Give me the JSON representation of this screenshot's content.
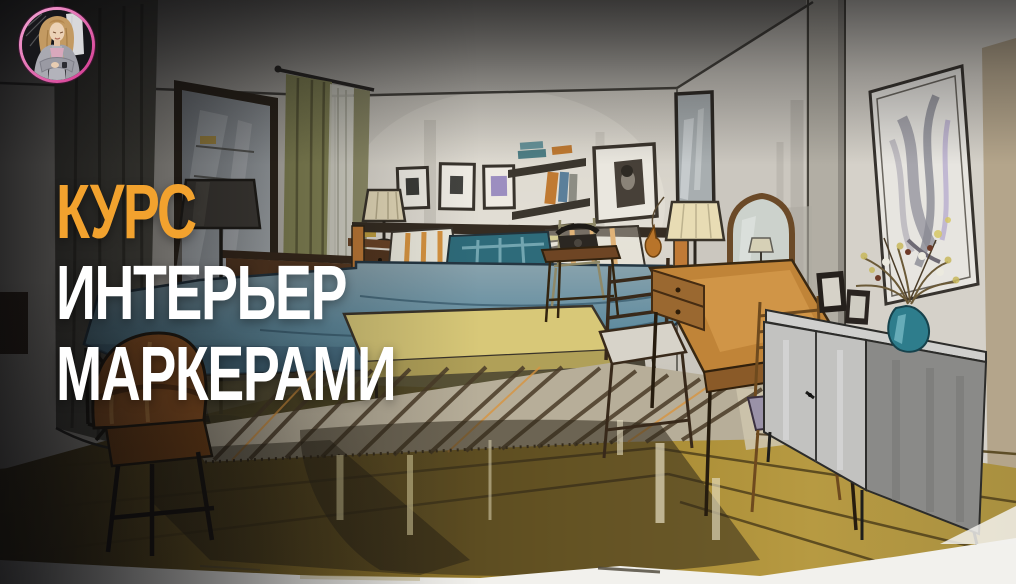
{
  "meta": {
    "kind": "video-thumbnail",
    "width": 1016,
    "height": 584
  },
  "theme": {
    "accent-orange": "#F2A22E",
    "title-white": "#FFFFFF",
    "ring-pink": "#D4368F",
    "ring-pink-light": "#F4A8D6"
  },
  "overlay": {
    "title_lines": [
      {
        "text": "КУРС"
      },
      {
        "text": "ИНТЕРЬЕР"
      },
      {
        "text": "МАРКЕРАМИ"
      }
    ]
  },
  "avatar": {
    "description": "Illustrated woman with long sandy hair, gray cardigan, arms crossed, in a pink ring"
  },
  "scene": {
    "medium": "hand-drawn marker sketch",
    "subject": "classic bedroom interior in two-point perspective",
    "objects": [
      "dark curtain at left edge",
      "wall mirror",
      "window with olive curtains and sheer",
      "floor lamp with dark shade",
      "chest of drawers",
      "nightstand with small lamp",
      "three framed pictures above bed",
      "wall shelves with books",
      "bed with teal bedding and striped pillows",
      "yellow bench at foot of bed",
      "striped rug",
      "framed portrait",
      "tall corner mirror",
      "telephone table with rotary phone",
      "ladder-back chair",
      "vanity desk with pleated lamp and arched mirror",
      "chair with lavender cushion",
      "gray credenza with photo frames and teal vase of flowers",
      "abstract framed art on right wall",
      "golden wooden plank floor",
      "foreground leather armchair"
    ],
    "colors": {
      "wall": "#D6D2C9",
      "ceiling": "#9E9B95",
      "floor": "#A3862F",
      "floor_dark": "#4F401C",
      "bedding": "#5D8A99",
      "accent_pillow": "#2E6B7A",
      "pillow_stripe": "#D89440",
      "bench": "#D8C878",
      "rug": "#B7AE99",
      "rug_stripe": "#4A3C28",
      "curtain": "#8A8A58",
      "wood_dark": "#5B3B22",
      "wood_warm": "#C08438",
      "credenza_front": "#C2C2C0",
      "credenza_side": "#8A8A88",
      "vase": "#2E7D8C",
      "armchair": "#A05C24"
    }
  }
}
